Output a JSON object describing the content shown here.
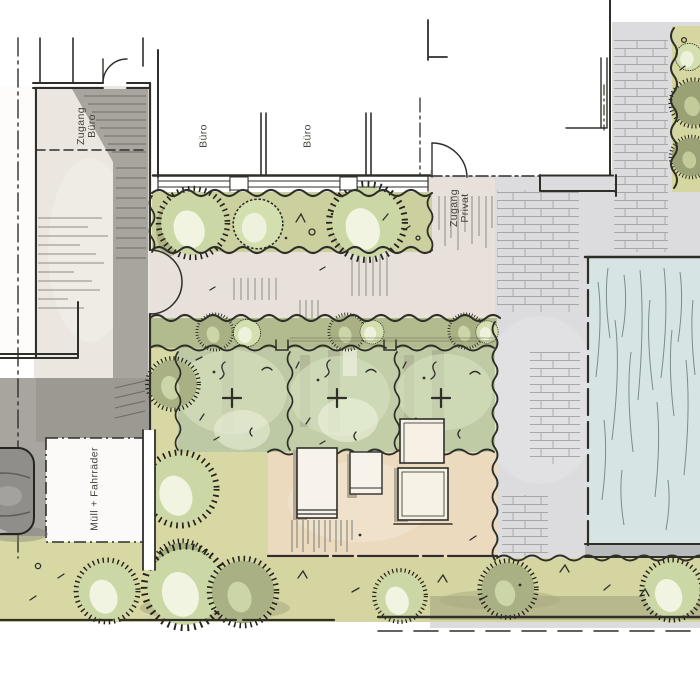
{
  "plan_labels": {
    "buero_room_1": "Büro",
    "buero_room_2": "Büro",
    "zugang_buero_line1": "Zugang",
    "zugang_buero_line2": "Büro",
    "zugang_privat_line1": "Zugang",
    "zugang_privat_line2": "Privat",
    "muell_fahrraeder": "Müll + Fahrräder"
  },
  "colors": {
    "ink": "#2f2f2a",
    "paper": "#ffffff",
    "plaza_gray": "#dcdcde",
    "access_path_gray": "#a8a59f",
    "driveway_beige": "#ebe6e0",
    "path_beige": "#e7e1da",
    "lawn_green": "#d8d8a4",
    "hedge_green": "#ccd09e",
    "garden_green": "#c0cca6",
    "courtyard_tan": "#ebdabe",
    "water_blue": "#d6e4e3",
    "shrub_green": "#cbd8a6",
    "car_gray": "#8f8e8a"
  },
  "symbols": {
    "shrub": "spiky-dashed-circle",
    "car": "rounded-rectangle-top-view",
    "pool": "blue-rect-with-ripple-lines",
    "door": "quarter-circle-arc",
    "property_line": "dash-dot-line"
  }
}
